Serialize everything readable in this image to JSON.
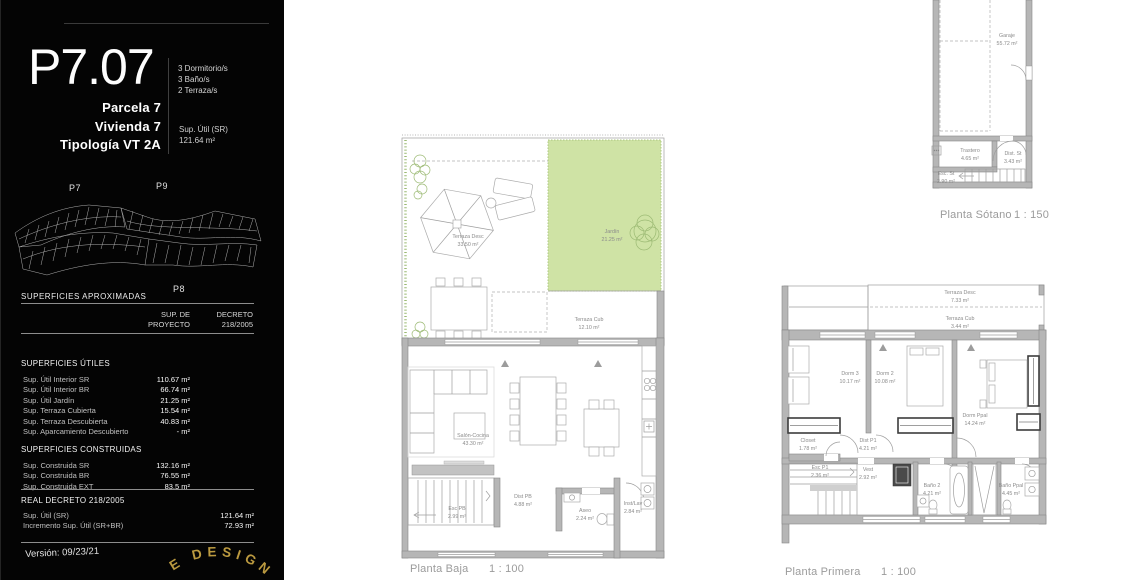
{
  "sidebar": {
    "code": "P7.07",
    "features": [
      "3 Dormitorio/s",
      "3 Baño/s",
      "2 Terraza/s"
    ],
    "identity": [
      "Parcela 7",
      "Vivienda 7",
      "Tipología VT 2A"
    ],
    "sup_util": {
      "label": "Sup. Útil (SR)",
      "value": "121.64 m²"
    },
    "site": {
      "p7": "P7",
      "p9": "P9",
      "p8": "P8"
    },
    "approx_title": "SUPERFICIES APROXIMADAS",
    "columns": {
      "c1a": "SUP. DE",
      "c1b": "PROYECTO",
      "c2a": "DECRETO",
      "c2b": "218/2005"
    },
    "utiles": {
      "title": "SUPERFICIES ÚTILES",
      "rows": [
        {
          "label": "Sup. Útil Interior SR",
          "value": "110.67 m²"
        },
        {
          "label": "Sup. Útil Interior BR",
          "value": "66.74 m²"
        },
        {
          "label": "Sup. Útil Jardín",
          "value": "21.25 m²"
        },
        {
          "label": "Sup. Terraza Cubierta",
          "value": "15.54 m²"
        },
        {
          "label": "Sup. Terraza Descubierta",
          "value": "40.83 m²"
        },
        {
          "label": "Sup. Aparcamiento Descubierto",
          "value": "- m²"
        }
      ]
    },
    "construidas": {
      "title": "SUPERFICIES CONSTRUIDAS",
      "rows": [
        {
          "label": "Sup. Construida SR",
          "value": "132.16 m²"
        },
        {
          "label": "Sup. Construida BR",
          "value": "76.55 m²"
        },
        {
          "label": "Sup. Construida EXT",
          "value": "83.5 m²"
        }
      ]
    },
    "decreto": {
      "title": "REAL DECRETO 218/2005",
      "rows": [
        {
          "label": "Sup. Útil (SR)",
          "value": "121.64 m²"
        },
        {
          "label": "Incremento Sup. Útil (SR+BR)",
          "value": "72.93 m²"
        }
      ]
    },
    "version": "Versión: 09/23/21",
    "logo_text": "E DESIGN"
  },
  "plans": {
    "baja": {
      "title": "Planta Baja",
      "scale": "1 : 100",
      "rooms": {
        "terraza_desc": {
          "name": "Terraza Desc",
          "area": "33.50 m²"
        },
        "jardin": {
          "name": "Jardín",
          "area": "21.25 m²"
        },
        "terraza_cub": {
          "name": "Terraza Cub",
          "area": "12.10 m²"
        },
        "salon": {
          "name": "Salón-Cocina",
          "area": "43.30 m²"
        },
        "dist": {
          "name": "Dist PB",
          "area": "4.88 m²"
        },
        "esc": {
          "name": "Esc PB",
          "area": "2.99 m²"
        },
        "aseo": {
          "name": "Aseo",
          "area": "2.24 m²"
        },
        "inst_lav": {
          "name": "Inst/Lav",
          "area": "2.84 m²"
        }
      }
    },
    "primera": {
      "title": "Planta Primera",
      "scale": "1 : 100",
      "rooms": {
        "terraza_desc": {
          "name": "Terraza Desc",
          "area": "7.33 m²"
        },
        "terraza_cub": {
          "name": "Terraza Cub",
          "area": "3.44 m²"
        },
        "dorm3": {
          "name": "Dorm 3",
          "area": "10.17 m²"
        },
        "dorm2": {
          "name": "Dorm 2",
          "area": "10.08 m²"
        },
        "dorm_ppal": {
          "name": "Dorm Ppal",
          "area": "14.24 m²"
        },
        "closet": {
          "name": "Closet",
          "area": "1.78 m²"
        },
        "dist": {
          "name": "Dist P1",
          "area": "4.21 m²"
        },
        "esc": {
          "name": "Esc P1",
          "area": "2.36 m²"
        },
        "vest": {
          "name": "Vest",
          "area": "2.92 m²"
        },
        "bano2": {
          "name": "Baño 2",
          "area": "4.21 m²"
        },
        "bano_ppal": {
          "name": "Baño Ppal",
          "area": "4.45 m²"
        }
      }
    },
    "sotano": {
      "title": "Planta Sótano",
      "scale": "1 : 150",
      "rooms": {
        "garaje": {
          "name": "Garaje",
          "area": "55.72 m²"
        },
        "trastero": {
          "name": "Trastero",
          "area": "4.65 m²"
        },
        "dist": {
          "name": "Dist. St",
          "area": "3.43 m²"
        },
        "esc": {
          "name": "Esc. St",
          "area": "2.90 m²"
        }
      }
    }
  },
  "colors": {
    "sidebar_bg": "#040404",
    "garden_green": "#cfe3a5",
    "wall_gray": "#b6b6b6",
    "plan_text_gray": "#8b8b8b",
    "accent_gold": "#bb9a40"
  }
}
